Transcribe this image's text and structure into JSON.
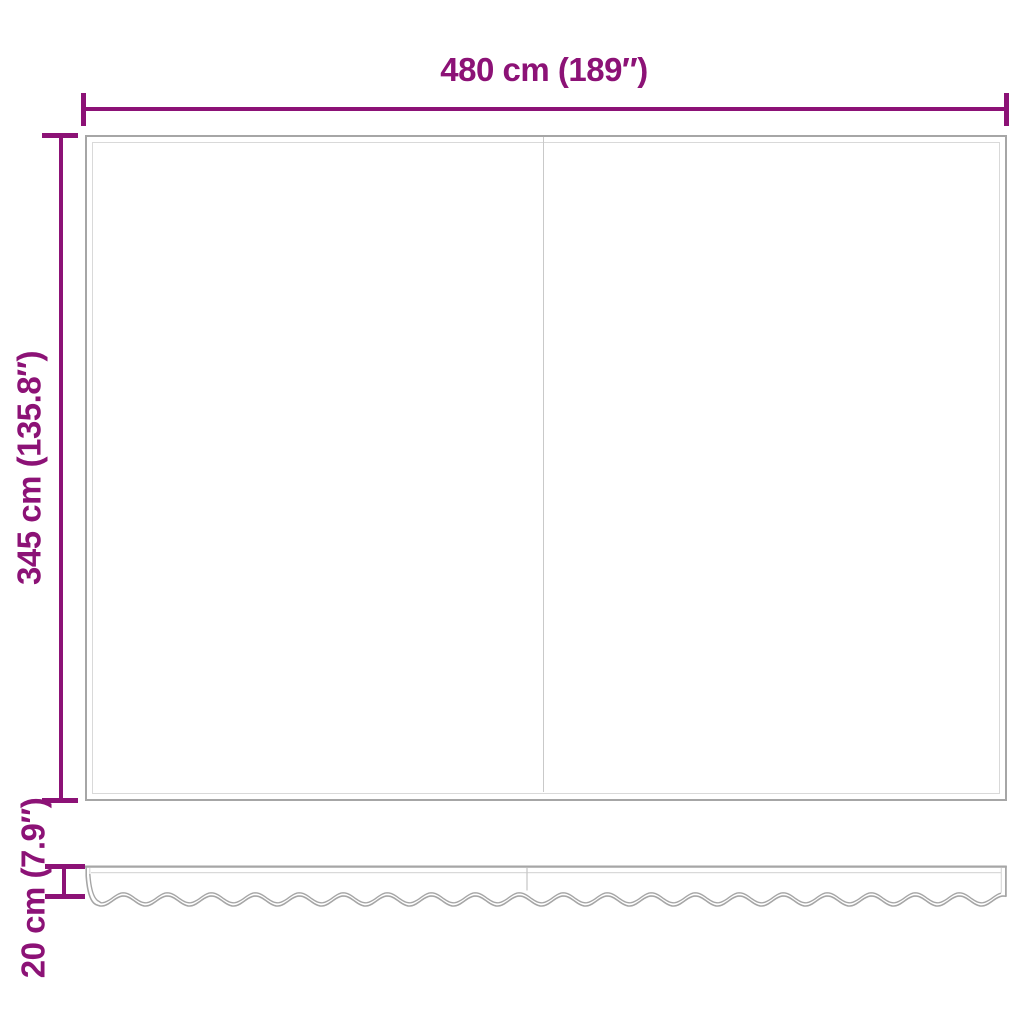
{
  "diagram": {
    "kind": "product-dimension-diagram",
    "dimensions": {
      "width": {
        "label": "480 cm (189″)"
      },
      "height": {
        "label": "345 cm (135.8″)"
      },
      "valance_height": {
        "label": "20 cm (7.9″)"
      }
    },
    "colors": {
      "dimension_accent": "#8C1276",
      "fabric_outline": "#a6a6a6",
      "fabric_hairline": "#d9d9d9",
      "fabric_seam": "#c9c9c9"
    }
  }
}
